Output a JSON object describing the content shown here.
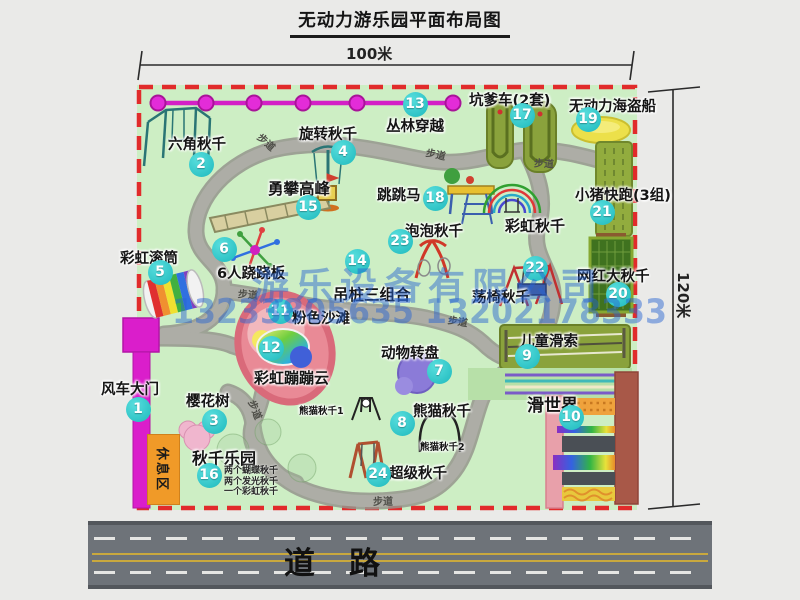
{
  "title": "无动力游乐园平面布局图",
  "dimensions": {
    "width_label": "100米",
    "height_label": "120米"
  },
  "road": {
    "label": "道路"
  },
  "rest_area": {
    "label": "休息区"
  },
  "watermark": {
    "company": "游乐设备有限公司",
    "phone": "13233805635 13202178333"
  },
  "colors": {
    "grass": "#cdeec4",
    "border_red": "#e12b2b",
    "badge": "#1eb9bd",
    "gate_magenta": "#da1ecb",
    "zipline_magenta": "#d320c6",
    "road": "#6e7379",
    "watermark": "rgba(40,100,210,0.48)",
    "path": "#adada6"
  },
  "items": [
    {
      "id": "windmill-gate",
      "num": 1,
      "label": "风车大门",
      "lx": 101,
      "ly": 378,
      "bx": 138,
      "by": 409
    },
    {
      "id": "hexagon-swing",
      "num": 2,
      "label": "六角秋千",
      "lx": 168,
      "ly": 133,
      "bx": 201,
      "by": 164
    },
    {
      "id": "cherry-tree",
      "num": 3,
      "label": "樱花树",
      "lx": 186,
      "ly": 390,
      "bx": 214,
      "by": 421
    },
    {
      "id": "rotating-swing",
      "num": 4,
      "label": "旋转秋千",
      "lx": 299,
      "ly": 123,
      "bx": 343,
      "by": 152
    },
    {
      "id": "rainbow-roller",
      "num": 5,
      "label": "彩虹滚筒",
      "lx": 120,
      "ly": 247,
      "bx": 160,
      "by": 272
    },
    {
      "id": "six-person-seesaw",
      "num": 6,
      "label": "6人跷跷板",
      "lx": 217,
      "ly": 262,
      "bx": 224,
      "by": 249
    },
    {
      "id": "animal-carousel",
      "num": 7,
      "label": "动物转盘",
      "lx": 381,
      "ly": 342,
      "bx": 439,
      "by": 371
    },
    {
      "id": "panda-swing",
      "num": 8,
      "label": "熊猫秋千",
      "lx": 413,
      "ly": 400,
      "bx": 402,
      "by": 423
    },
    {
      "id": "kids-zipline",
      "num": 9,
      "label": "儿童滑索",
      "lx": 520,
      "ly": 330,
      "bx": 527,
      "by": 356
    },
    {
      "id": "slide-world",
      "num": 10,
      "label": "滑世界",
      "lx": 527,
      "ly": 391,
      "bx": 571,
      "by": 417,
      "fs": 17
    },
    {
      "id": "pink-beach",
      "num": 11,
      "label": "粉色沙滩",
      "lx": 292,
      "ly": 307,
      "bx": 280,
      "by": 311
    },
    {
      "id": "rainbow-bounce-cloud",
      "num": 12,
      "label": "彩虹蹦蹦云",
      "lx": 254,
      "ly": 367,
      "bx": 271,
      "by": 348,
      "fs": 15
    },
    {
      "id": "jungle-traverse",
      "num": 13,
      "label": "丛林穿越",
      "lx": 386,
      "ly": 115,
      "bx": 415,
      "by": 104
    },
    {
      "id": "hanging-piles-combo",
      "num": 14,
      "label": "吊桩三组合",
      "lx": 333,
      "ly": 283,
      "bx": 357,
      "by": 261,
      "fs": 15.5
    },
    {
      "id": "peak-climbing",
      "num": 15,
      "label": "勇攀高峰",
      "lx": 268,
      "ly": 177,
      "bx": 308,
      "by": 207,
      "fs": 15.5
    },
    {
      "id": "swing-paradise",
      "num": 16,
      "label": "秋千乐园",
      "lx": 192,
      "ly": 445,
      "bx": 209,
      "by": 475,
      "fs": 16,
      "sub": [
        "两个蝴蝶秋千",
        "两个发光秋千",
        "一个彩虹秋千"
      ],
      "subx": 224,
      "suby": 466
    },
    {
      "id": "kengdie-cars",
      "num": 17,
      "label": "坑爹车(2套)",
      "lx": 469,
      "ly": 89,
      "bx": 522,
      "by": 115
    },
    {
      "id": "jumping-horse",
      "num": 18,
      "label": "跳跳马",
      "lx": 377,
      "ly": 184,
      "bx": 435,
      "by": 198
    },
    {
      "id": "pirate-ship",
      "num": 19,
      "label": "无动力海盗船",
      "lx": 569,
      "ly": 95,
      "bx": 588,
      "by": 119
    },
    {
      "id": "big-net-swing",
      "num": 20,
      "label": "网红大秋千",
      "lx": 577,
      "ly": 265,
      "bx": 618,
      "by": 294
    },
    {
      "id": "piggy-run",
      "num": 21,
      "label": "小猪快跑(3组)",
      "lx": 575,
      "ly": 184,
      "bx": 602,
      "by": 212
    },
    {
      "id": "chair-swing",
      "num": 22,
      "label": "荡椅秋千",
      "lx": 472,
      "ly": 286,
      "bx": 535,
      "by": 268
    },
    {
      "id": "bubble-swing",
      "num": 23,
      "label": "泡泡秋千",
      "lx": 405,
      "ly": 220,
      "bx": 400,
      "by": 241
    },
    {
      "id": "super-swing",
      "num": 24,
      "label": "超级秋千",
      "lx": 389,
      "ly": 462,
      "bx": 378,
      "by": 474
    }
  ],
  "extra_labels": [
    {
      "id": "rainbow-swing-label",
      "text": "彩虹秋千",
      "x": 505,
      "y": 215,
      "fs": 15
    },
    {
      "id": "panda-swing-1-label",
      "text": "熊猫秋千1",
      "x": 299,
      "y": 403,
      "fs": 9.5
    },
    {
      "id": "panda-swing-2-label",
      "text": "熊猫秋千2",
      "x": 420,
      "y": 439,
      "fs": 9.5
    }
  ],
  "path_labels": [
    {
      "text": "步道",
      "x": 257,
      "y": 134,
      "rot": 42
    },
    {
      "text": "步道",
      "x": 426,
      "y": 146,
      "rot": 12
    },
    {
      "text": "步道",
      "x": 534,
      "y": 155,
      "rot": 3
    },
    {
      "text": "步道",
      "x": 238,
      "y": 286,
      "rot": 5
    },
    {
      "text": "步道",
      "x": 448,
      "y": 313,
      "rot": 10
    },
    {
      "text": "步道",
      "x": 246,
      "y": 402,
      "rot": 68
    },
    {
      "text": "步道",
      "x": 373,
      "y": 493,
      "rot": 0
    }
  ]
}
